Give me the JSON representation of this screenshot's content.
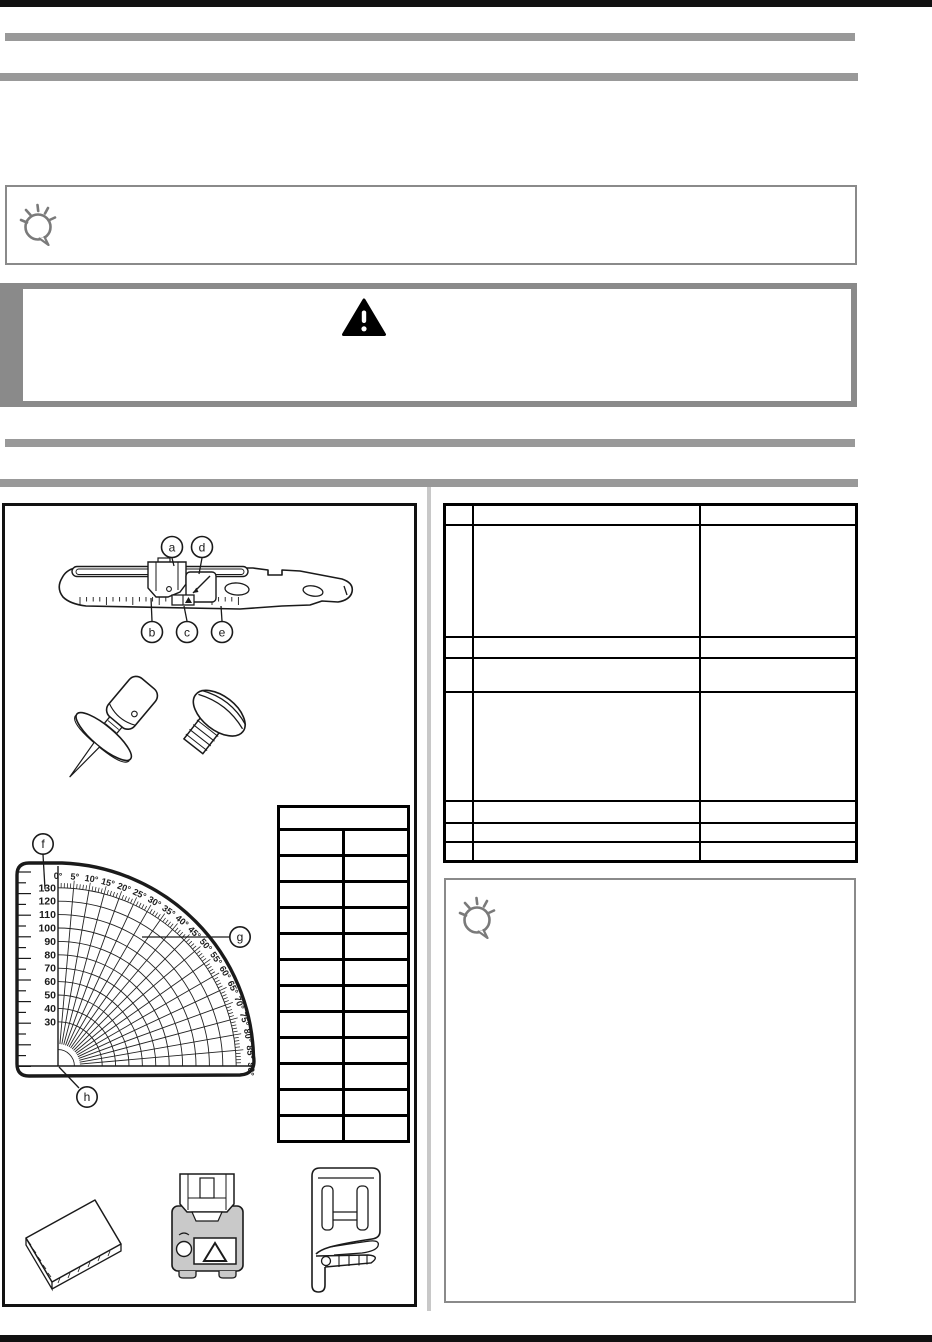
{
  "page": {
    "background": "#ffffff",
    "rule_color": "#111111",
    "section_bar_color": "#999999",
    "box_border_color": "#8a8a8a",
    "divider_color": "#c8c8c8",
    "line_art_color": "#1a1a1a",
    "foot_fill_color": "#c9c9c9"
  },
  "top_note_box": {
    "icon": "lightbulb-icon",
    "text": ""
  },
  "caution_box": {
    "icon": "warning-triangle-icon",
    "text": ""
  },
  "bottom_note_box": {
    "icon": "lightbulb-icon",
    "text": ""
  },
  "ruler_illustration": {
    "callouts": [
      "a",
      "b",
      "c",
      "d",
      "e"
    ]
  },
  "gauge_illustration": {
    "callouts": [
      "f",
      "g",
      "h"
    ],
    "radius_labels": [
      130,
      120,
      110,
      100,
      90,
      80,
      70,
      60,
      50,
      40,
      30
    ],
    "angle_labels": [
      "0°",
      "5°",
      "10°",
      "15°",
      "20°",
      "25°",
      "30°",
      "35°",
      "40°",
      "45°",
      "50°",
      "55°",
      "60°",
      "65°",
      "70°",
      "75°",
      "80°",
      "85°",
      "90°"
    ]
  },
  "left_table": {
    "rows": [
      [
        ""
      ],
      [
        "",
        ""
      ],
      [
        "",
        ""
      ],
      [
        "",
        ""
      ],
      [
        "",
        ""
      ],
      [
        "",
        ""
      ],
      [
        "",
        ""
      ],
      [
        "",
        ""
      ],
      [
        "",
        ""
      ],
      [
        "",
        ""
      ],
      [
        "",
        ""
      ],
      [
        "",
        ""
      ],
      [
        "",
        ""
      ]
    ]
  },
  "right_table": {
    "rows": [
      [
        "",
        "",
        ""
      ],
      [
        "",
        "",
        ""
      ],
      [
        "",
        "",
        ""
      ],
      [
        "",
        "",
        ""
      ],
      [
        "",
        "",
        ""
      ],
      [
        "",
        "",
        ""
      ],
      [
        "",
        "",
        ""
      ],
      [
        "",
        "",
        ""
      ]
    ]
  }
}
